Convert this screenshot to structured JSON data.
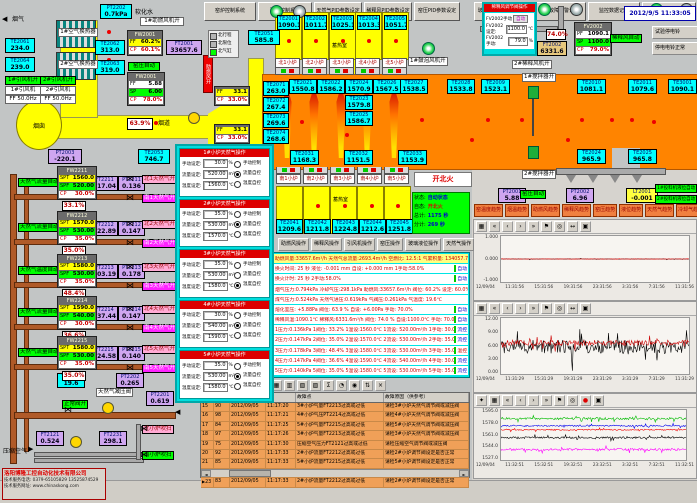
{
  "window": {
    "datetime": "2012/9/5 11:33:05"
  },
  "colors": {
    "duct_yellow": "#ffff00",
    "melter_orange": "#ff8400",
    "sensor_cyan": "#00ffff",
    "inst_purple": "#cfa6f0",
    "status_green": "#00ff00",
    "alarm_row_orange": "#f0a058",
    "header_red": "#dd0000",
    "popup_cyan": "#00dede"
  },
  "top_left": {
    "flue_gas_label": "烟气",
    "soft_water_label": "软化水",
    "chimney_label": "烟囱",
    "flue_duct_label": "烟道",
    "hx1_label": "1#空气换热器",
    "hx2_label": "2#空气换热器",
    "fan1_on": "1#引风机开",
    "fan2_on": "2#引风机开",
    "fan1": "1#引风机",
    "fan2": "2#引风机",
    "fan1_ff": "FF 50.0Hz",
    "fan2_ff": "FF 50.0Hz",
    "booster_fan_on": "1#助燃风机开",
    "booster_duct_label": "助燃风开",
    "kiln_pressure_auto": "窑压自动",
    "fw2001a": {
      "title": "FW2001",
      "rows": [
        {
          "k": "FF",
          "v": "60.2%",
          "c": "y"
        },
        {
          "k": "CP",
          "v": "60.1%",
          "c": "r"
        }
      ]
    },
    "fw2001b": {
      "title": "FW2001",
      "rows": [
        {
          "k": "FF",
          "v": "5.88",
          "c": "w"
        },
        {
          "k": "SP",
          "v": "6.00",
          "c": "g"
        },
        {
          "k": "CP",
          "v": "78.0%",
          "c": "r"
        }
      ]
    },
    "damper_pct": "63.9%",
    "aux1": {
      "rows": [
        {
          "k": "FF",
          "v": "33.1",
          "c": "y"
        },
        {
          "k": "CP",
          "v": "33.0%",
          "c": "r"
        }
      ]
    },
    "aux2": {
      "rows": [
        {
          "k": "FF",
          "v": "33.1",
          "c": "y"
        },
        {
          "k": "CP",
          "v": "33.0%",
          "c": "r"
        }
      ]
    },
    "legend": [
      {
        "label": "北行程",
        "state": "off"
      },
      {
        "label": "北限位",
        "state": "off"
      },
      {
        "label": "北气缸",
        "state": "on"
      }
    ]
  },
  "top_right": {
    "dilution_popup": {
      "title": "稀释风调节阀操作",
      "manual_btn": "FV2002手动",
      "auto_btn": "自动",
      "set_label": "FV2002设定:",
      "set_value": "1100.0",
      "set_unit": "℃",
      "man_label": "FV2002手动:",
      "man_value": "79.0",
      "man_unit": "%"
    },
    "fv2002": {
      "title": "FV2002",
      "rows": [
        {
          "k": "PF",
          "v": "1090.1",
          "c": "w"
        },
        {
          "k": "SP",
          "v": "1100.0",
          "c": "g"
        },
        {
          "k": "CP",
          "v": "79.0%",
          "c": "r"
        }
      ]
    },
    "dilution_auto": "稀释风自动",
    "dilution_pct": "74.0%",
    "bell_test_btn": "试验停电铃",
    "bell_ok_btn": "停电电铃正常",
    "dilution2_on": "2#稀释风机开",
    "stirrer1_on": "1#搅拌器开",
    "stirrer2_on": "2#搅拌器开",
    "bubbler1_on": "1#鼓泡风机开",
    "feeder1_auto": "1#投料机液位自动",
    "feeder2_auto": "2#投料机液位自动",
    "kiln_pressure_auto": "窑压自动"
  },
  "furnace": {
    "regenerator_label": "蓄热室",
    "north_tabs": [
      "北1小炉",
      "北2小炉",
      "北3小炉",
      "北4小炉",
      "北5小炉"
    ],
    "south_tabs": [
      "南1小炉",
      "南2小炉",
      "南3小炉",
      "南4小炉",
      "南5小炉"
    ],
    "fire_button": "开北火",
    "status_panel": {
      "rows": [
        {
          "k": "状态:",
          "v": "自动状态",
          "c": "blue"
        },
        {
          "k": "自态:",
          "v": "开北火",
          "c": "red"
        },
        {
          "k": "总计:",
          "v": "1175 秒",
          "c": "blue"
        },
        {
          "k": "分计:",
          "v": "269 秒",
          "c": "blue"
        }
      ]
    }
  },
  "sensors": [
    {
      "id": "PT2202",
      "value": "0.7kPa"
    },
    {
      "id": "TE2061",
      "value": "234.0"
    },
    {
      "id": "TE2064",
      "value": "239.0"
    },
    {
      "id": "TE2062",
      "value": "313.0"
    },
    {
      "id": "TE2063",
      "value": "319.0"
    },
    {
      "id": "PT2003",
      "value": "-220.1",
      "type": "pt"
    },
    {
      "id": "TE2053",
      "value": "746.7"
    },
    {
      "id": "TE2051",
      "value": "585.8"
    },
    {
      "id": "TE2001",
      "value": "1090.1"
    },
    {
      "id": "TE2002",
      "value": "1011.7"
    },
    {
      "id": "TE2003",
      "value": "1025.1"
    },
    {
      "id": "TE2004",
      "value": "1013.3"
    },
    {
      "id": "TE2005",
      "value": "1051.7"
    },
    {
      "id": "TE2071",
      "value": "263.0"
    },
    {
      "id": "TE2072",
      "value": "267.4"
    },
    {
      "id": "TE2073",
      "value": "269.6"
    },
    {
      "id": "TE2074",
      "value": "268.6"
    },
    {
      "id": "TE2021",
      "value": "1550.8"
    },
    {
      "id": "TE2022",
      "value": "1586.2"
    },
    {
      "id": "TE2024",
      "value": "1570.9"
    },
    {
      "id": "TE2023",
      "value": "1579.8"
    },
    {
      "id": "TE2025",
      "value": "1586.7"
    },
    {
      "id": "TE2026",
      "value": "1567.5"
    },
    {
      "id": "TE2027",
      "value": "1538.5"
    },
    {
      "id": "TE2028",
      "value": "1533.8"
    },
    {
      "id": "TE2031",
      "value": "1168.3"
    },
    {
      "id": "TE2032",
      "value": "1151.5"
    },
    {
      "id": "TE2033",
      "value": "1153.9"
    },
    {
      "id": "TE2009",
      "value": "1523.1"
    },
    {
      "id": "TE2010",
      "value": "1081.1"
    },
    {
      "id": "TE2011",
      "value": "1079.6"
    },
    {
      "id": "TE3001",
      "value": "1090.1"
    },
    {
      "id": "TE2024",
      "value": "965.9"
    },
    {
      "id": "TE2025",
      "value": "965.8"
    },
    {
      "id": "TE2041",
      "value": "1209.6"
    },
    {
      "id": "TE2042",
      "value": "1211.8"
    },
    {
      "id": "TE2043",
      "value": "1224.8"
    },
    {
      "id": "TE2044",
      "value": "1212.6"
    },
    {
      "id": "TE2045",
      "value": "1251.8"
    },
    {
      "id": "PT2001",
      "value": "5.88",
      "type": "pt"
    },
    {
      "id": "PT2002",
      "value": "6.96",
      "type": "pt"
    },
    {
      "id": "LT2001",
      "value": "-0.001",
      "type": "lt"
    },
    {
      "id": "FT2001",
      "value": "33657.6",
      "type": "pt"
    },
    {
      "id": "FT2002",
      "value": "6331.6",
      "type": "tan"
    },
    {
      "id": "FT2211",
      "value": "517.04",
      "type": "pt"
    },
    {
      "id": "PT2211",
      "value": "0.136",
      "type": "pt"
    },
    {
      "id": "FT2212",
      "value": "522.89",
      "type": "pt"
    },
    {
      "id": "PT2212",
      "value": "0.147",
      "type": "pt"
    },
    {
      "id": "FT2213",
      "value": "603.19",
      "type": "pt"
    },
    {
      "id": "PT2213",
      "value": "0.178",
      "type": "pt"
    },
    {
      "id": "FT2214",
      "value": "537.44",
      "type": "pt"
    },
    {
      "id": "PT2214",
      "value": "0.147",
      "type": "pt"
    },
    {
      "id": "FT2215",
      "value": "524.58",
      "type": "pt"
    },
    {
      "id": "PT2215",
      "value": "0.140",
      "type": "pt"
    },
    {
      "id": "TE2201",
      "value": "19.6"
    },
    {
      "id": "PT2202",
      "value": "0.265",
      "type": "pt"
    },
    {
      "id": "PT2201",
      "value": "0.619",
      "type": "pt"
    },
    {
      "id": "FT2121",
      "value": "0.524",
      "type": "pt"
    },
    {
      "id": "FT2231",
      "value": "298.1",
      "type": "pt"
    }
  ],
  "gas_loops": [
    {
      "auto_label": "天然气流量自动",
      "panel_title": "FW2211",
      "spt": "1560.0",
      "spf": "520.00",
      "cp": "30.0%",
      "pct": "33.1%",
      "north": "北1天然气开",
      "south": "南1天然气开"
    },
    {
      "auto_label": "天然气流量自动",
      "panel_title": "FW2212",
      "spt": "1570.0",
      "spf": "530.00",
      "cp": "35.0%",
      "pct": "35.0%",
      "north": "北2天然气开",
      "south": "南2天然气开"
    },
    {
      "auto_label": "天然气温度自动",
      "panel_title": "FW2213",
      "spt": "1580.0",
      "spf": "530.00",
      "cp": "35.0%",
      "pct": "48.4%",
      "north": "北3天然气开",
      "south": "南3天然气开"
    },
    {
      "auto_label": "天然气流量自动",
      "panel_title": "FW2214",
      "spt": "1590.0",
      "spf": "540.00",
      "cp": "30.0%",
      "pct": "36.6%",
      "north": "北4天然气开",
      "south": "南4天然气开"
    },
    {
      "auto_label": "天然气流量自动",
      "panel_title": "FW2215",
      "spt": "1580.0",
      "spf": "530.00",
      "cp": "35.0%",
      "pct": "35.0%",
      "north": "北5天然气开",
      "south": "南5天然气开"
    }
  ],
  "gas_popup": {
    "labels": {
      "manual": "手动设定:",
      "flow": "流量设定:",
      "temp": "温度设定:",
      "u_manual": "%",
      "u_flow": "m³/h",
      "u_temp": "℃",
      "modes": [
        "手动控制",
        "流量自控",
        "温度自控"
      ]
    },
    "panels": [
      {
        "title": "1#小炉天然气操作",
        "manual": "30.0",
        "flow": "520.00",
        "temp": "1560.0",
        "mode": 1
      },
      {
        "title": "2#小炉天然气操作",
        "manual": "35.0",
        "flow": "530.00",
        "temp": "1570.0",
        "mode": 1
      },
      {
        "title": "3#小炉天然气操作",
        "manual": "35.0",
        "flow": "530.00",
        "temp": "1580.0",
        "mode": 2
      },
      {
        "title": "4#小炉天然气操作",
        "manual": "30.0",
        "flow": "540.00",
        "temp": "1590.0",
        "mode": 1
      },
      {
        "title": "5#小炉天然气操作",
        "manual": "35.0",
        "flow": "530.00",
        "temp": "1580.0",
        "mode": 1
      }
    ]
  },
  "monitor": {
    "rows": [
      {
        "text": "助燃风量:33657.6m³/h 天然气总流量:2693.4m³/h 空燃比: 12.5:1 气累积量: 134057.7m³",
        "cls": "hl"
      },
      {
        "text": "换火时间: 25 秒  液位: -0.001 mm  自设: +0.000 mm  1手动:58.0%",
        "badge": "自动",
        "bc": "auto"
      },
      {
        "text": "换火计时: 25 秒  2手动:58.0%",
        "badge": "自动",
        "bc": "auto"
      },
      {
        "text": "烟气压力:0.794kPa 冷却气压:298.1kPa 助燃风:33657.6m³/h 阀位: 60.2% 设定: 60.0%"
      },
      {
        "text": "煤气压力:0.524kPa 天然气进压:0.619kPa 气阀压:0.261kPa 气温度: 19.6℃"
      },
      {
        "text": "熔化室压: +5.88Pa  阀位: 63.9 %  自设: +6.00Pa  手动: 70.0%",
        "badge": "自动",
        "bc": "auto"
      },
      {
        "text": "稀释风温:1090.1℃ 稀释风:6331.6m³/h 阀位: 74.0 % 自设:1100.0℃ 手动: 70.0%",
        "badge": "自动",
        "bc": "auto"
      },
      {
        "text": "1压力:0.136kPa 1阀位: 33.2% 1温设:1560.0℃ 1流设: 520.00m³/h 1手动: 30.0%",
        "badge": "流控",
        "bc": "flow"
      },
      {
        "text": "2压力:0.147kPa 2阀位: 35.0% 2温设:1570.0℃ 2流设: 530.00m³/h 2手动: 35.0%",
        "badge": "流控",
        "bc": "flow"
      },
      {
        "text": "3压力:0.178kPa 3阀位: 48.4% 3温设:1580.0℃ 3流设: 530.00m³/h 3手动: 35.0%",
        "badge": "温控",
        "bc": "temp"
      },
      {
        "text": "4压力:0.147kPa 4阀位: 36.6% 4温设:1590.0℃ 4流设: 540.00m³/h 4手动: 30.0%",
        "badge": "流控",
        "bc": "flow"
      },
      {
        "text": "5压力:0.140kPa 5阀位: 35.0% 5温设:1580.0℃ 5流设: 530.00m³/h 5手动: 35.0%",
        "badge": "流控",
        "bc": "flow"
      }
    ]
  },
  "op_buttons": [
    "助燃风操作",
    "稀释风操作",
    "引风机操作",
    "窑压操作",
    "玻璃液位操作",
    "天然气操作"
  ],
  "trend_buttons": [
    "窑温度趋势",
    "烟温趋势",
    "助燃风趋势",
    "稀释风趋势",
    "窑压趋势",
    "液位趋势",
    "天然气趋势",
    "冷却气趋势"
  ],
  "charts": [
    {
      "type": "line",
      "name": "液位趋势",
      "yticks": [
        "1.000",
        "0.000",
        "-1.000"
      ],
      "ylim": [
        -1.25,
        1.25
      ],
      "xlabels": [
        "12/09/04",
        "11:31:56",
        "15:31:56",
        "19:31:56",
        "23:31:56",
        "3:31:56",
        "7:31:56",
        "11:31:56"
      ],
      "toolbar": [
        "grid-icon",
        "first-icon",
        "prev-icon",
        "next-icon",
        "last-icon",
        "flag-icon",
        "zoom-icon",
        "span-icon",
        "save-icon"
      ],
      "series": [
        {
          "name": "液位",
          "color": "#000000",
          "base": 0,
          "amp": 0.02
        },
        {
          "name": "液位设定",
          "color": "#ff0000",
          "base": 0,
          "amp": 0.01
        }
      ]
    },
    {
      "type": "line",
      "name": "窑压趋势",
      "yticks": [
        "12.00",
        "9.00",
        "6.00",
        "3.00",
        "0.00"
      ],
      "ylim": [
        0,
        12.75
      ],
      "xlabels": [
        "12/09/04",
        "11:31:29",
        "15:31:29",
        "19:31:29",
        "23:31:29",
        "3:31:29",
        "7:31:29",
        "11:31:29"
      ],
      "toolbar": [
        "grid-icon",
        "first-icon",
        "prev-icon",
        "next-icon",
        "last-icon",
        "flag-icon",
        "zoom-icon",
        "span-icon",
        "save-icon"
      ],
      "series": [
        {
          "name": "窑压",
          "color": "#000000",
          "base": 6.2,
          "amp": 2.8
        },
        {
          "name": "窑压设定",
          "color": "#cc0000",
          "base": 7.1,
          "amp": 1.1
        }
      ]
    },
    {
      "type": "line",
      "name": "窑温度趋势",
      "yticks": [
        "1595.0",
        "1578.0",
        "1561.0",
        "1544.0",
        "1527.0"
      ],
      "ylim": [
        1523,
        1599
      ],
      "xlabels": [
        "12/09/04",
        "11:32:51",
        "15:32:51",
        "19:32:51",
        "23:32:51",
        "3:32:51",
        "7:32:51",
        "11:32:51"
      ],
      "toolbar": [
        "key-icon",
        "grid-icon",
        "first-icon",
        "prev-icon",
        "next-icon",
        "last-icon",
        "flag-icon",
        "zoom-icon",
        "stop-icon",
        "save-icon"
      ],
      "series": [
        {
          "name": "TE绿",
          "color": "#00bb00",
          "base": 1586,
          "amp": 3
        },
        {
          "name": "TE蓝",
          "color": "#0000ee",
          "base": 1575,
          "amp": 2
        },
        {
          "name": "TE红",
          "color": "#ee0000",
          "base": 1569,
          "amp": 1.5
        },
        {
          "name": "TE黑",
          "color": "#000000",
          "base": 1557,
          "amp": 2.5
        },
        {
          "name": "TE紫",
          "color": "#ff00ff",
          "base": 1539,
          "amp": 3
        }
      ]
    }
  ],
  "alarm_toolbar": [
    "printer-icon",
    "list-icon",
    "help-icon",
    "grid-icon",
    "grid2-icon",
    "grid3-icon",
    "grid4-icon",
    "sum-icon",
    "clock-icon",
    "lock-icon",
    "sort-icon",
    "close-icon"
  ],
  "alarm_table": {
    "headers": {
      "point": "故障点",
      "reason": "故障原因（供参考）"
    },
    "rows": [
      {
        "idx": "15",
        "code": "90",
        "date": "2012/09/05",
        "time": "11:17:20",
        "point": "3#小炉气量FT2213过高或过低",
        "reason": "请检3#小炉天然气调节阀或减压阀"
      },
      {
        "idx": "16",
        "code": "98",
        "date": "2012/09/05",
        "time": "11:17:21",
        "point": "4#小炉气压PT2214过高或过低",
        "reason": "请检4#小炉天然气调节阀或减压阀"
      },
      {
        "idx": "17",
        "code": "84",
        "date": "2012/09/05",
        "time": "11:17:25",
        "point": "5#小炉气量FT2215过高或过低",
        "reason": "请检5#小炉天然气调节阀或减压阀"
      },
      {
        "idx": "18",
        "code": "97",
        "date": "2012/09/05",
        "time": "11:17:26",
        "point": "3#小炉气量FT2213过高或过低",
        "reason": "请检3#小炉天然气调节阀或减压阀"
      },
      {
        "idx": "19",
        "code": "75",
        "date": "2012/09/05",
        "time": "11:17:30",
        "point": "压缩空气压力FT2121过高或过低",
        "reason": "请检压缩空气调节阀或减压阀"
      },
      {
        "idx": "20",
        "code": "92",
        "date": "2012/09/05",
        "time": "11:17:33",
        "point": "2#小炉流量FT2212过高或过低",
        "reason": "请检2#小炉调节阀设定是否正常"
      },
      {
        "idx": "21",
        "code": "85",
        "date": "2012/09/05",
        "time": "11:17:33",
        "point": "5#小炉流量FT2215过高或过低",
        "reason": "请检5#小炉调节阀设定是否正常"
      },
      {
        "idx": "22",
        "code": "81",
        "date": "2012/09/05",
        "time": "11:17:33",
        "point": "1#小炉流量FT2211过高或过低",
        "reason": "请检1#小炉调节阀设定是否正常"
      },
      {
        "idx": "23",
        "code": "83",
        "date": "2012/09/05",
        "time": "11:17:33",
        "point": "2#小炉流量FT2212过高或过低",
        "reason": "请检2#小炉调节阀设定是否正常",
        "selected": true
      }
    ]
  },
  "bottom_left_area": {
    "pressure_valve_label": "天然气减压阀",
    "valve_ok": "正常阀开",
    "purge_north": "北小炉吹扫",
    "purge_south": "南小炉吹扫",
    "compressed_air": "压缩空气"
  },
  "company": {
    "name": "洛阳博隆工控自动化技术有限公司",
    "phone": "技术服务电话: 0379-65105829  13525874529",
    "web": "技术服务网址: www.chinaskong.com"
  },
  "bottom_buttons_left": [
    "窑炉控制系统",
    "配料控制系统",
    "天然气PID参数设定",
    "稀释风PID参数设定",
    "窑压PID参数设定"
  ],
  "bottom_buttons_right": [
    "玻璃液位PID参数设定",
    "监控故障报警记录",
    "监控数据记录",
    "系统报警值设定"
  ]
}
